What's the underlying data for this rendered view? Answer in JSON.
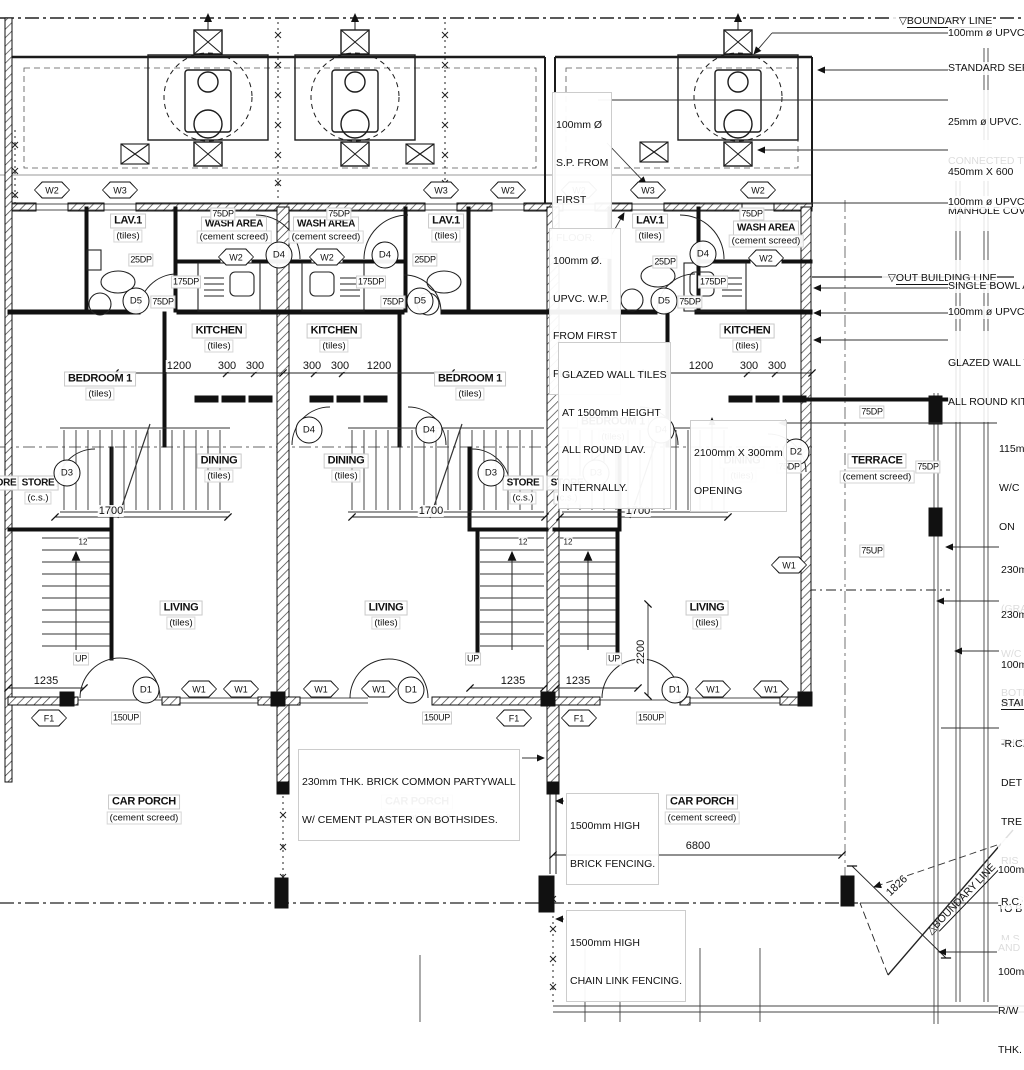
{
  "drawing": {
    "boundary_top": "BOUNDARY LINE",
    "out_building": "OUT BUILDING LINE",
    "boundary_diag": "BOUNDARY LINE",
    "marker_down": "▽",
    "marker_tri": "△"
  },
  "rooms": {
    "lav": {
      "name": "LAV.1",
      "finish": "(tiles)"
    },
    "wash": {
      "name": "WASH AREA",
      "finish": "(cement screed)"
    },
    "kitchen": {
      "name": "KITCHEN",
      "finish": "(tiles)"
    },
    "bedroom": {
      "name": "BEDROOM 1",
      "finish": "(tiles)"
    },
    "dining": {
      "name": "DINING",
      "finish": "(tiles)"
    },
    "living": {
      "name": "LIVING",
      "finish": "(tiles)"
    },
    "store": {
      "name": "STORE",
      "finish": "(c.s.)"
    },
    "terrace": {
      "name": "TERRACE",
      "finish": "(cement screed)"
    },
    "carporch": {
      "name": "CAR PORCH",
      "finish": "(cement screed)"
    }
  },
  "tags": {
    "w1": "W1",
    "w2": "W2",
    "w3": "W3",
    "f1": "F1",
    "d1": "D1",
    "d2": "D2",
    "d3": "D3",
    "d4": "D4",
    "d5": "D5"
  },
  "marks": {
    "dp25": "25DP",
    "dp75": "75DP",
    "dp175": "175DP",
    "up75": "75UP",
    "up150": "150UP",
    "up": "UP",
    "treads": "12"
  },
  "dims": {
    "w1200": "1200",
    "w300": "300",
    "s1700": "1700",
    "e1235": "1235",
    "v2200": "2200",
    "p6800": "6800",
    "g1826": "1826"
  },
  "notes": {
    "sp": [
      "100mm Ø",
      "S.P. FROM",
      "FIRST",
      "FLOOR."
    ],
    "wp": [
      "100mm Ø.",
      "UPVC. W.P.",
      "FROM FIRST",
      "FLOOR."
    ],
    "glazed": [
      "GLAZED WALL TILES",
      "AT 1500mm HEIGHT",
      "ALL ROUND LAV.",
      "INTERNALLY."
    ],
    "opening": [
      "2100mm X 300mm",
      "OPENING"
    ],
    "partywall": [
      "230mm THK. BRICK COMMON PARTYWALL",
      "W/ CEMENT PLASTER ON BOTHSIDES."
    ],
    "brickfence": [
      "1500mm HIGH",
      "BRICK FENCING."
    ],
    "chainlink": [
      "1500mm HIGH",
      "CHAIN LINK FENCING."
    ]
  },
  "callouts": {
    "upvc_top": "100mm ø UPVC",
    "septic": "STANDARD SEPT",
    "upvc25": [
      "25mm ø UPVC.",
      "CONNECTED TO"
    ],
    "manhole": [
      "450mm X 600",
      "MANHOLE COVER"
    ],
    "upvc_mid": "100mm ø UPVC",
    "bowl": "SINGLE BOWL A",
    "upvc_out": "100mm ø UPVC",
    "glazed_kitchen": [
      "GLAZED WALL T",
      "ALL ROUND KIT"
    ],
    "wall115": [
      "115m",
      "W/C",
      "ON"
    ],
    "grade230": [
      "230m",
      "(GRA"
    ],
    "wall230": [
      "230m",
      "W/C",
      "BOTH"
    ],
    "rwp100": [
      "100m",
      "R/W",
      "THIC"
    ],
    "stair_head": "STAIR",
    "stair": [
      "-R.C.",
      "DET",
      "TRE",
      "RIS",
      "-M.S",
      "M.S"
    ],
    "tob100": [
      "100m",
      "TO B",
      "AND"
    ],
    "rc": "R.C.",
    "thk100": [
      "100m",
      "R/W",
      "THK."
    ]
  }
}
